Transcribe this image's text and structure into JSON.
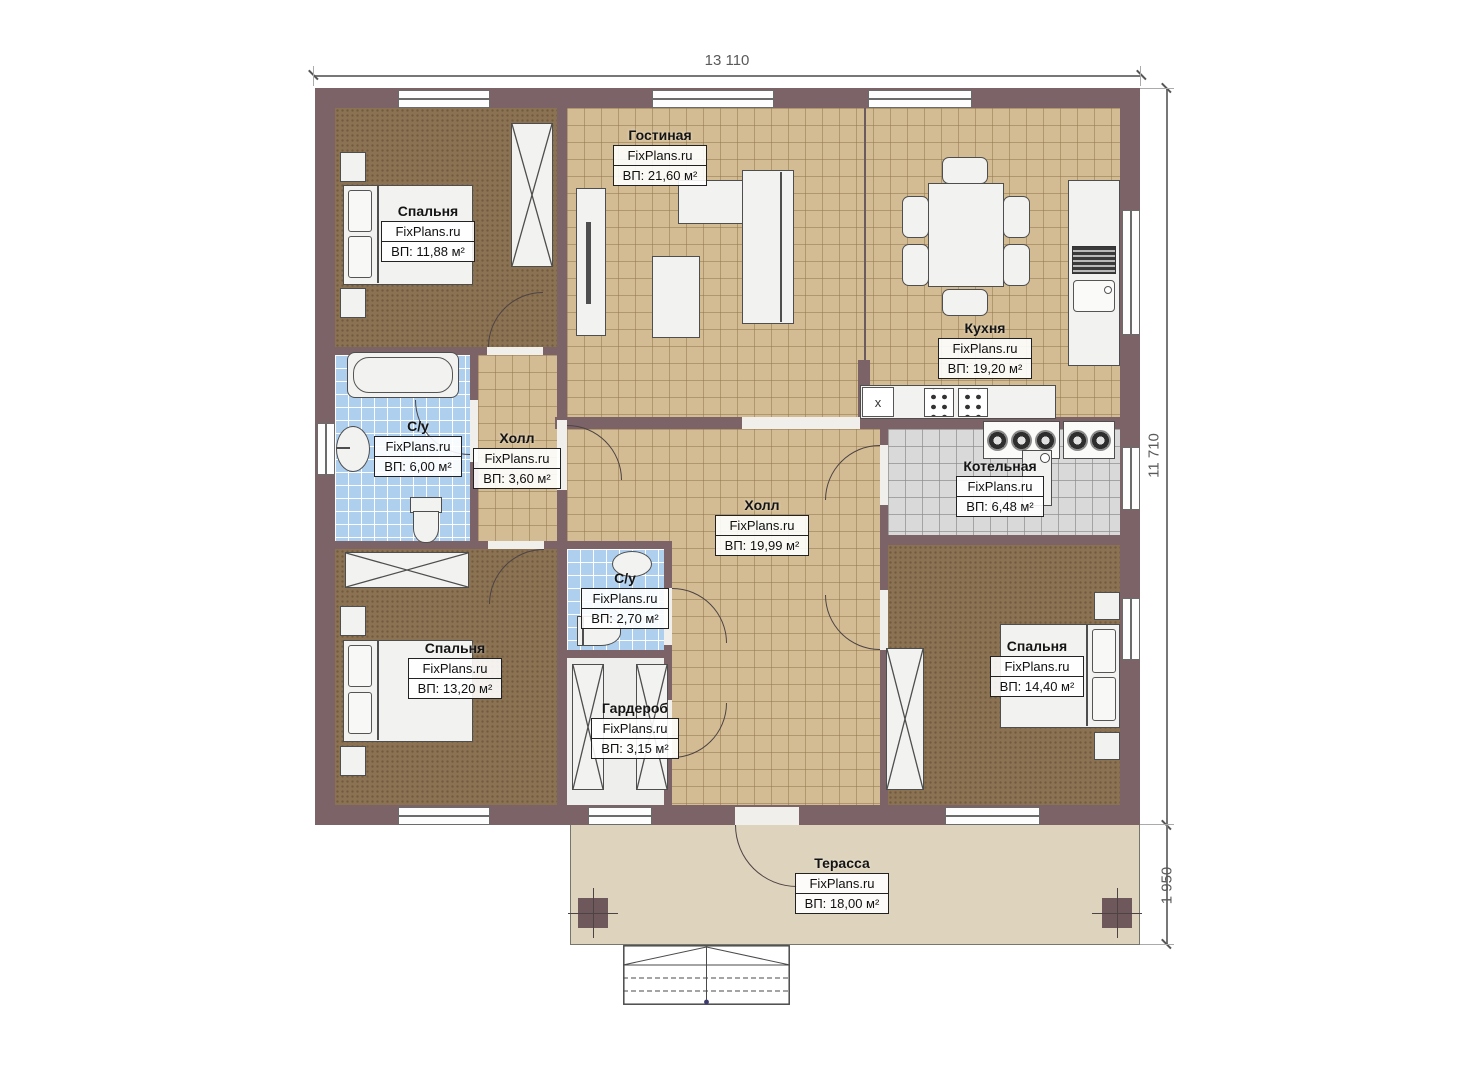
{
  "plan": {
    "brand": "FixPlans.ru",
    "dimensions": {
      "width": "13 110",
      "height": "11 710",
      "terrace_depth": "1 950"
    },
    "rooms": [
      {
        "key": "living",
        "name": "Гостиная",
        "area": "ВП: 21,60 м²"
      },
      {
        "key": "bedroom-top-left",
        "name": "Спальня",
        "area": "ВП: 11,88 м²"
      },
      {
        "key": "kitchen",
        "name": "Кухня",
        "area": "ВП: 19,20 м²"
      },
      {
        "key": "bathroom-main",
        "name": "С/у",
        "area": "ВП: 6,00 м²"
      },
      {
        "key": "hall-small",
        "name": "Холл",
        "area": "ВП: 3,60 м²"
      },
      {
        "key": "hall-central",
        "name": "Холл",
        "area": "ВП: 19,99 м²"
      },
      {
        "key": "boiler-room",
        "name": "Котельная",
        "area": "ВП: 6,48 м²"
      },
      {
        "key": "bathroom-small",
        "name": "С/у",
        "area": "ВП: 2,70 м²"
      },
      {
        "key": "bedroom-bottom-left",
        "name": "Спальня",
        "area": "ВП: 13,20 м²"
      },
      {
        "key": "wardrobe-room",
        "name": "Гардероб",
        "area": "ВП: 3,15 м²"
      },
      {
        "key": "bedroom-right",
        "name": "Спальня",
        "area": "ВП: 14,40 м²"
      },
      {
        "key": "terrace",
        "name": "Терасса",
        "area": "ВП: 18,00 м²"
      }
    ],
    "markers": {
      "kitchen_x": "x"
    },
    "colors": {
      "wall": "#7b6367",
      "tile_floor": "#d3bc93",
      "bathroom_tile": "#aecfee",
      "boiler_tile": "#d9d9d9",
      "bedroom_carpet": "#8b7252",
      "terrace": "#ded3bc"
    }
  }
}
